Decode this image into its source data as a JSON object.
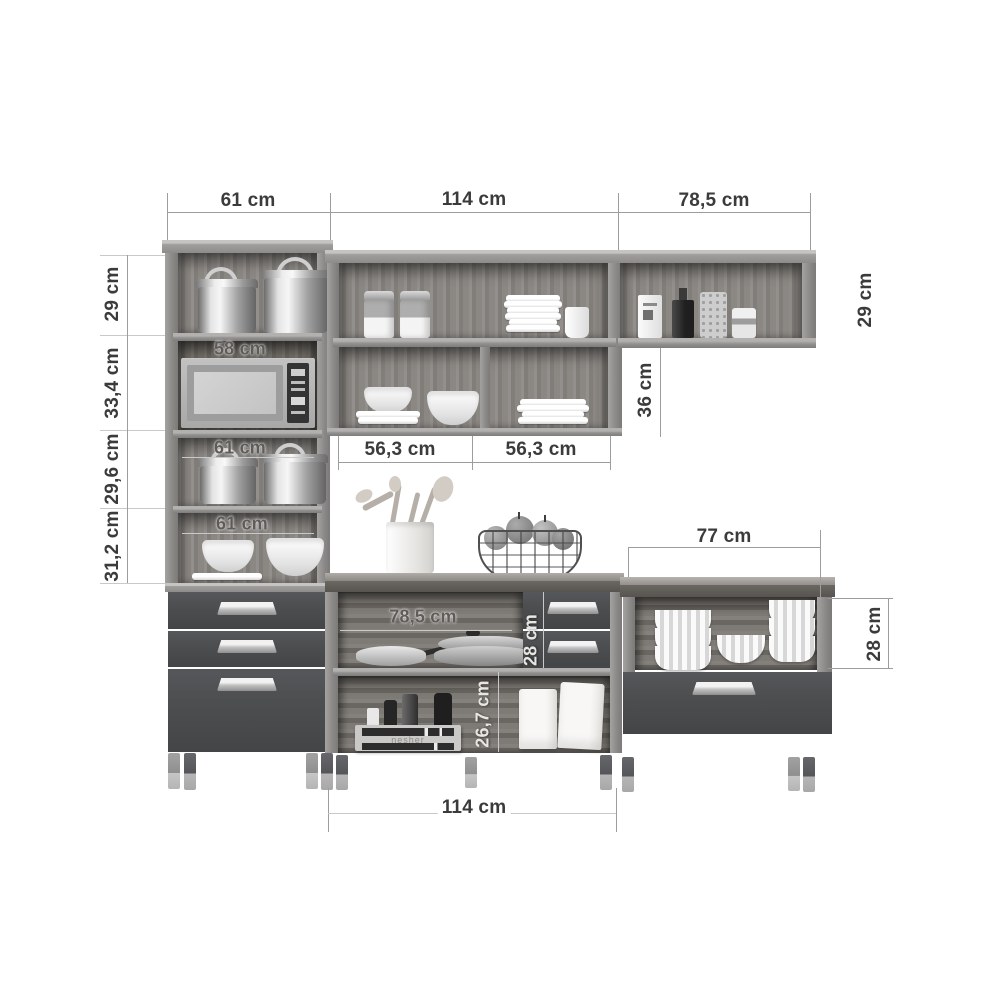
{
  "diagram_title": "kitchen-cabinet-set-dimension-diagram",
  "colors": {
    "background": "#ffffff",
    "dimension_line": "#9d9d9d",
    "dimension_text": "#3b3b3b",
    "cabinet_front": "#4c4e50",
    "carcass_wood": "#8e8c8a",
    "handle_silver": "#c2c2c2"
  },
  "dims": {
    "w_tall": "61 cm",
    "w_wall_mid": "114 cm",
    "w_wall_right": "78,5 cm",
    "h_tall_s1": "29 cm",
    "h_tall_s2": "33,4 cm",
    "h_tall_s3": "29,6 cm",
    "h_tall_s4": "31,2 cm",
    "w_micro_niche": "58 cm",
    "w_niche_s3": "61 cm",
    "w_niche_s4": "61 cm",
    "w_comp_left": "56,3 cm",
    "w_comp_right": "56,3 cm",
    "h_wall_right": "29 cm",
    "h_wall_drop": "36 cm",
    "w_base_right": "77 cm",
    "w_pan_niche": "78,5 cm",
    "h_mid_drawers": "28 cm",
    "h_lower_niche": "26,7 cm",
    "h_right_niche": "28 cm",
    "w_counter": "114 cm"
  },
  "decor": {
    "crate_text": "nesher",
    "items": [
      "stock-pots",
      "microwave",
      "bowls",
      "plates",
      "glass-jars",
      "cup",
      "bottles",
      "ramekins",
      "frying-pans",
      "wooden-crate",
      "paper-bags",
      "utensil-crock",
      "fruit-basket"
    ]
  }
}
